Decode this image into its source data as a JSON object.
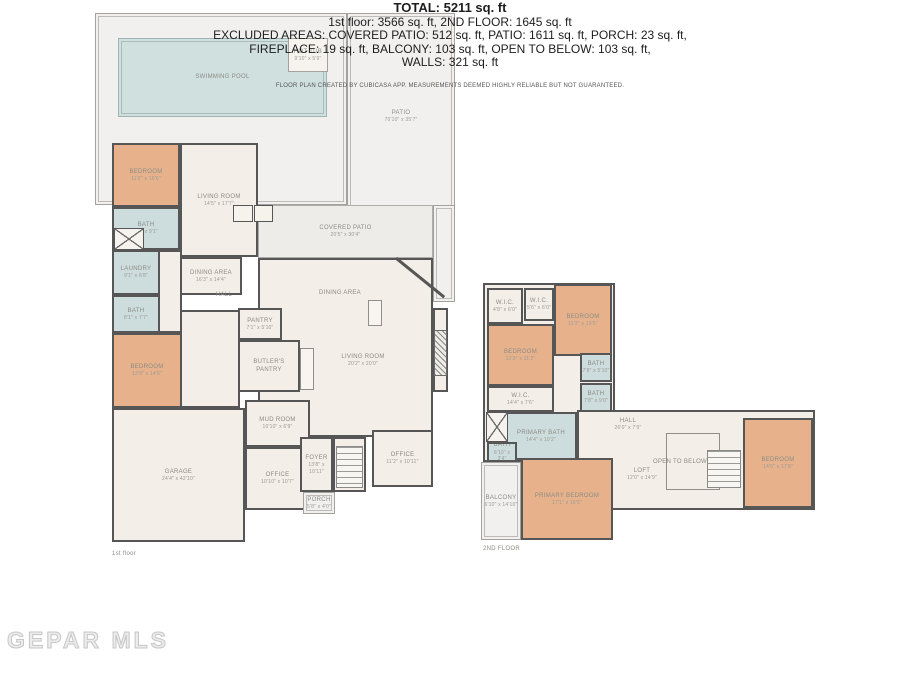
{
  "watermark": "GEPAR MLS",
  "summary": {
    "total": "TOTAL: 5211 sq. ft",
    "line2": "1st floor: 3566 sq. ft, 2ND FLOOR: 1645 sq. ft",
    "line3": "EXCLUDED AREAS: COVERED PATIO: 512 sq. ft, PATIO: 1611 sq. ft, PORCH: 23 sq. ft,",
    "line4": "FIREPLACE: 19 sq. ft, BALCONY: 103 sq. ft, OPEN TO BELOW: 103 sq. ft,",
    "line5": "WALLS: 321 sq. ft",
    "disclaimer": "FLOOR PLAN CREATED BY CUBICASA APP. MEASUREMENTS DEEMED HIGHLY RELIABLE BUT NOT GUARANTEED."
  },
  "colors": {
    "wall": "#565656",
    "bedroom_fill": "#e7b28b",
    "bath_fill": "#cddddd",
    "floor_fill": "#f3eee7",
    "patio_fill": "#f1f0ee",
    "pool_fill": "#cfe0de",
    "label_text": "#8b8b85"
  },
  "floor1": {
    "caption": "1st floor",
    "areas": [
      {
        "id": "patio-pool",
        "label": "",
        "dims": "",
        "x": 95,
        "y": 13,
        "w": 252,
        "h": 192,
        "fill": "patio"
      },
      {
        "id": "patio-right",
        "label": "PATIO",
        "dims": "70'10\" x 35'7\"",
        "x": 347,
        "y": 13,
        "w": 108,
        "h": 245,
        "fill": "patio",
        "lt": 95
      },
      {
        "id": "patio-extension",
        "label": "",
        "dims": "",
        "x": 433,
        "y": 205,
        "w": 22,
        "h": 97,
        "fill": "patio"
      },
      {
        "id": "covered-patio",
        "label": "COVERED PATIO",
        "dims": "20'5\" x 30'4\"",
        "x": 258,
        "y": 205,
        "w": 175,
        "h": 53,
        "fill": "patio2"
      },
      {
        "id": "swimming-pool",
        "label": "SWIMMING POOL",
        "dims": "",
        "x": 118,
        "y": 38,
        "w": 209,
        "h": 79,
        "fill": "pool"
      },
      {
        "id": "hot-tub",
        "label": "HOT TUB",
        "dims": "9'10\" x 5'9\"",
        "x": 288,
        "y": 38,
        "w": 40,
        "h": 34,
        "fill": "floorlight"
      },
      {
        "id": "open-space",
        "label": "",
        "dims": "",
        "x": 258,
        "y": 258,
        "w": 175,
        "h": 179,
        "fill": "floor",
        "wall": true
      },
      {
        "id": "living-bay",
        "label": "",
        "dims": "",
        "x": 433,
        "y": 308,
        "w": 15,
        "h": 84,
        "fill": "floor",
        "wall": true
      },
      {
        "id": "bedroom-1",
        "label": "BEDROOM",
        "dims": "11'2\" x 10'6\"",
        "x": 112,
        "y": 143,
        "w": 68,
        "h": 64,
        "fill": "bedroom",
        "wall": true
      },
      {
        "id": "living-room-1",
        "label": "LIVING ROOM",
        "dims": "14'5\" x 17'7\"",
        "x": 180,
        "y": 143,
        "w": 78,
        "h": 114,
        "fill": "floor",
        "wall": true
      },
      {
        "id": "bath-1",
        "label": "BATH",
        "dims": "7'4\" x 9'1\"",
        "x": 112,
        "y": 207,
        "w": 68,
        "h": 43,
        "fill": "bath",
        "wall": true
      },
      {
        "id": "hall-passage",
        "label": "",
        "dims": "",
        "x": 158,
        "y": 250,
        "w": 24,
        "h": 83,
        "fill": "floor",
        "wall": true
      },
      {
        "id": "laundry",
        "label": "LAUNDRY",
        "dims": "9'1\" x 6'8\"",
        "x": 112,
        "y": 250,
        "w": 48,
        "h": 45,
        "fill": "bath",
        "wall": true
      },
      {
        "id": "bath-2",
        "label": "BATH",
        "dims": "8'1\" x 7'7\"",
        "x": 112,
        "y": 295,
        "w": 48,
        "h": 38,
        "fill": "bath",
        "wall": true
      },
      {
        "id": "bedroom-2",
        "label": "BEDROOM",
        "dims": "13'9\" x 14'6\"",
        "x": 112,
        "y": 333,
        "w": 70,
        "h": 75,
        "fill": "bedroom",
        "wall": true
      },
      {
        "id": "hallway",
        "label": "",
        "dims": "",
        "x": 180,
        "y": 310,
        "w": 60,
        "h": 98,
        "fill": "floor",
        "wall": true
      },
      {
        "id": "dining-area-1",
        "label": "DINING AREA",
        "dims": "16'3\" x 14'4\"",
        "x": 180,
        "y": 257,
        "w": 62,
        "h": 38,
        "fill": "floor",
        "wall": true
      },
      {
        "id": "pantry",
        "label": "PANTRY",
        "dims": "7'1\" x 5'10\"",
        "x": 238,
        "y": 308,
        "w": 44,
        "h": 32,
        "fill": "floor",
        "wall": true
      },
      {
        "id": "butlers-pantry",
        "label": "BUTLER'S PANTRY",
        "dims": "",
        "x": 238,
        "y": 340,
        "w": 62,
        "h": 52,
        "fill": "floor",
        "wall": true
      },
      {
        "id": "garage",
        "label": "GARAGE",
        "dims": "24'4\" x 42'10\"",
        "x": 112,
        "y": 408,
        "w": 133,
        "h": 134,
        "fill": "floor",
        "wall": true
      },
      {
        "id": "mud-room",
        "label": "MUD ROOM",
        "dims": "10'10\" x 6'9\"",
        "x": 245,
        "y": 400,
        "w": 65,
        "h": 47,
        "fill": "floor",
        "wall": true
      },
      {
        "id": "office-1",
        "label": "OFFICE",
        "dims": "10'10\" x 10'7\"",
        "x": 245,
        "y": 447,
        "w": 65,
        "h": 63,
        "fill": "floor",
        "wall": true
      },
      {
        "id": "foyer",
        "label": "FOYER",
        "dims": "13'8\" x 10'11\"",
        "x": 300,
        "y": 437,
        "w": 33,
        "h": 55,
        "fill": "floor",
        "wall": true
      },
      {
        "id": "stair-well",
        "label": "",
        "dims": "",
        "x": 333,
        "y": 437,
        "w": 33,
        "h": 55,
        "fill": "floor",
        "wall": true
      },
      {
        "id": "office-2",
        "label": "OFFICE",
        "dims": "11'2\" x 10'11\"",
        "x": 372,
        "y": 430,
        "w": 61,
        "h": 57,
        "fill": "floor",
        "wall": true
      },
      {
        "id": "porch",
        "label": "PORCH",
        "dims": "5'8\" x 4'0\"",
        "x": 303,
        "y": 492,
        "w": 32,
        "h": 22,
        "fill": "patio"
      },
      {
        "id": "hall-1",
        "label": "HALL",
        "dims": "",
        "x": 196,
        "y": 288,
        "w": 56,
        "h": 14,
        "fill": "none"
      },
      {
        "id": "dining-area-2",
        "label": "DINING AREA",
        "dims": "",
        "x": 300,
        "y": 286,
        "w": 80,
        "h": 14,
        "fill": "none"
      },
      {
        "id": "living-room-2",
        "label": "LIVING ROOM",
        "dims": "20'2\" x 20'0\"",
        "x": 318,
        "y": 348,
        "w": 90,
        "h": 24,
        "fill": "none"
      }
    ]
  },
  "floor2": {
    "caption": "2ND FLOOR",
    "areas": [
      {
        "id": "upper-left-block",
        "label": "",
        "dims": "",
        "x": 483,
        "y": 283,
        "w": 132,
        "h": 179,
        "fill": "floor",
        "wall": true
      },
      {
        "id": "upper-right-block",
        "label": "",
        "dims": "",
        "x": 577,
        "y": 410,
        "w": 238,
        "h": 100,
        "fill": "floor",
        "wall": true
      },
      {
        "id": "wic-1",
        "label": "W.I.C.",
        "dims": "4'8\" x 6'0\"",
        "x": 487,
        "y": 288,
        "w": 36,
        "h": 36,
        "fill": "floor",
        "wall": true
      },
      {
        "id": "wic-2",
        "label": "W.I.C.",
        "dims": "5'6\" x 6'0\"",
        "x": 524,
        "y": 288,
        "w": 30,
        "h": 33,
        "fill": "floor",
        "wall": true
      },
      {
        "id": "bedroom-3",
        "label": "BEDROOM",
        "dims": "11'2\" x 13'5\"",
        "x": 554,
        "y": 284,
        "w": 58,
        "h": 72,
        "fill": "bedroom",
        "wall": true
      },
      {
        "id": "bedroom-4",
        "label": "BEDROOM",
        "dims": "12'9\" x 11'2\"",
        "x": 487,
        "y": 324,
        "w": 67,
        "h": 62,
        "fill": "bedroom",
        "wall": true
      },
      {
        "id": "bath-3",
        "label": "BATH",
        "dims": "7'8\" x 5'10\"",
        "x": 580,
        "y": 353,
        "w": 32,
        "h": 29,
        "fill": "bath",
        "wall": true
      },
      {
        "id": "bath-4",
        "label": "BATH",
        "dims": "7'8\" x 9'0\"",
        "x": 580,
        "y": 383,
        "w": 32,
        "h": 29,
        "fill": "bath",
        "wall": true
      },
      {
        "id": "wic-3",
        "label": "W.I.C.",
        "dims": "14'4\" x 7'6\"",
        "x": 487,
        "y": 386,
        "w": 67,
        "h": 26,
        "fill": "floor",
        "wall": true
      },
      {
        "id": "primary-bath",
        "label": "PRIMARY BATH",
        "dims": "14'4\" x 10'2\"",
        "x": 505,
        "y": 412,
        "w": 72,
        "h": 48,
        "fill": "bath",
        "wall": true
      },
      {
        "id": "bath-5",
        "label": "BATH",
        "dims": "6'10\" x 3'4\"",
        "x": 487,
        "y": 442,
        "w": 30,
        "h": 20,
        "fill": "bath",
        "wall": true
      },
      {
        "id": "balcony",
        "label": "BALCONY",
        "dims": "6'10\" x 14'10\"",
        "x": 481,
        "y": 462,
        "w": 40,
        "h": 78,
        "fill": "patio"
      },
      {
        "id": "primary-bedroom",
        "label": "PRIMARY BEDROOM",
        "dims": "17'1\" x 16'5\"",
        "x": 521,
        "y": 458,
        "w": 92,
        "h": 82,
        "fill": "bedroom",
        "wall": true
      },
      {
        "id": "bedroom-5",
        "label": "BEDROOM",
        "dims": "14'6\" x 17'8\"",
        "x": 743,
        "y": 418,
        "w": 70,
        "h": 90,
        "fill": "bedroom",
        "wall": true
      },
      {
        "id": "hall-2",
        "label": "HALL",
        "dims": "26'0\" x 7'9\"",
        "x": 598,
        "y": 414,
        "w": 60,
        "h": 20,
        "fill": "none"
      },
      {
        "id": "loft",
        "label": "LOFT",
        "dims": "12'0\" x 14'9\"",
        "x": 613,
        "y": 462,
        "w": 58,
        "h": 24,
        "fill": "none"
      },
      {
        "id": "open-to-below",
        "label": "OPEN TO BELOW",
        "dims": "",
        "x": 648,
        "y": 456,
        "w": 64,
        "h": 12,
        "fill": "none"
      }
    ]
  }
}
